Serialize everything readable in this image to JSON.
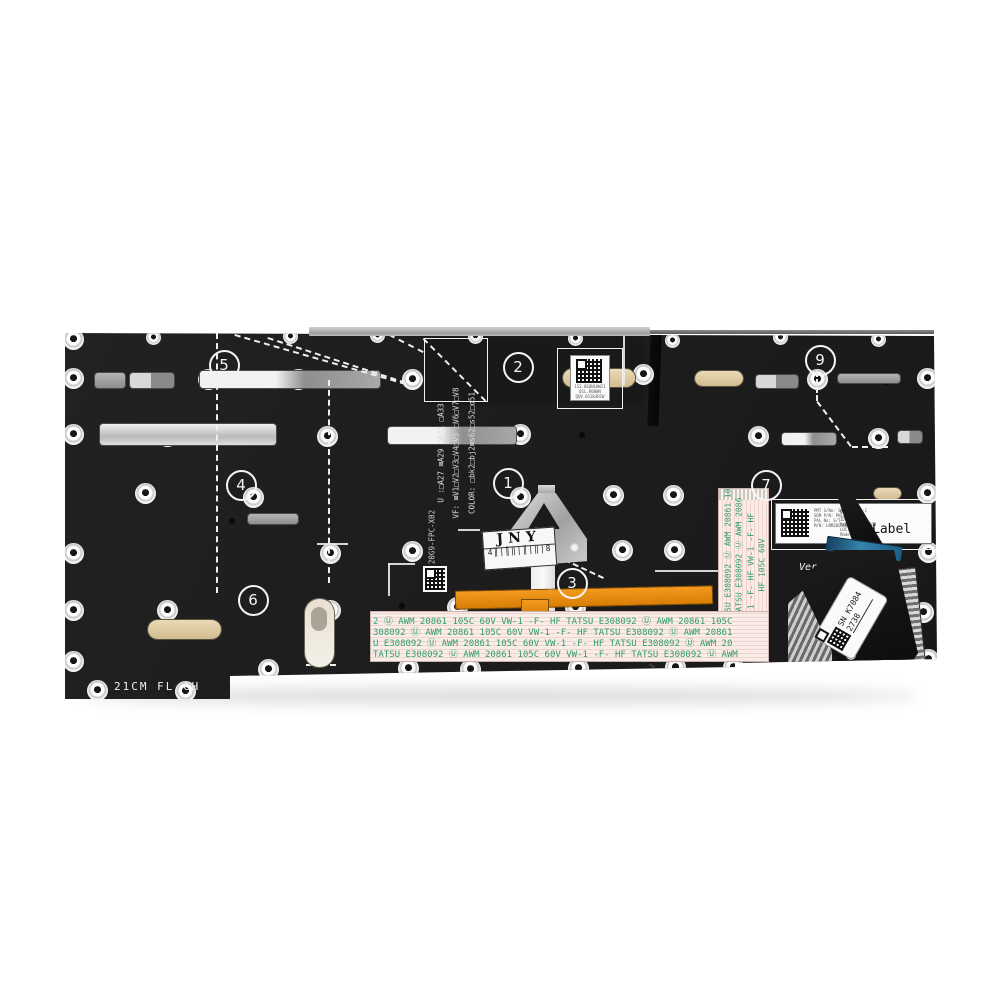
{
  "scene": {
    "description": "Product photo: rear side of a black laptop keyboard backplate with numbered callouts, ribbon cables and service labels",
    "background_color": "#ffffff"
  },
  "colors": {
    "plate": "#1d1d1d",
    "kapton_orange": "#e8890f",
    "ffc_background": "#f9ede9",
    "ffc_text_green": "#2f9e68",
    "connector_blue": "#2b6e93",
    "silver": "#c6c6c6"
  },
  "plate": {
    "bottom_marking": "21CM FL CH",
    "fpc_part_number": "20G9-FPC-X02",
    "config_lines": [
      "U :□A27 ⊠A29 □A31 □A33",
      "VF: ⊠V1□V2□V3□V4□V5 □V6□V7□V8",
      "COLOR: □bk2□bj2⊠s62□s52□o51"
    ],
    "ver_text": "Ver"
  },
  "callouts": {
    "items": [
      {
        "n": "1",
        "x": 506,
        "y": 481
      },
      {
        "n": "2",
        "x": 516,
        "y": 365
      },
      {
        "n": "3",
        "x": 570,
        "y": 581
      },
      {
        "n": "4",
        "x": 239,
        "y": 483
      },
      {
        "n": "5",
        "x": 222,
        "y": 363
      },
      {
        "n": "6",
        "x": 251,
        "y": 598
      },
      {
        "n": "7",
        "x": 764,
        "y": 483
      },
      {
        "n": "9",
        "x": 818,
        "y": 358
      }
    ]
  },
  "labels": {
    "qr_label": {
      "micro_lines": [
        "1S2.0SONLHW21",
        "01L.R080N",
        "QQV.0S1B3RCW"
      ]
    },
    "jny": {
      "title": "JNY",
      "barcode": "4║|║‖|║|‖|8"
    },
    "info": {
      "big_text": "Label",
      "cert_prefix": "c",
      "cert_mark": "UL",
      "cert_suffix": "us",
      "micro_left": [
        "PMT S/No: SN21A22080-C",
        "SDM P/N: PN131UP2B11",
        "PAL No: S/T",
        "M/N: LNM20G9KBD-USLX02"
      ],
      "micro_right": [
        "ID: L19IM3D",
        "M/N: 21YB. 85GB",
        "LOC: UHS. KBN",
        "Made in China"
      ]
    },
    "sn": {
      "line1": "SN K7084",
      "line2": "2738"
    }
  },
  "ffc": {
    "rows": [
      "2 Ⓤ AWM 20861 105C 60V VW-1 -F- HF        TATSU E308092 Ⓤ AWM 20861 105C",
      "308092 Ⓤ AWM 20861 105C 60V VW-1 -F- HF       TATSU E308092 Ⓤ AWM 20861",
      "U E308092 Ⓤ AWM 20861 105C 60V VW-1 -F- HF       TATSU E308092 Ⓤ AWM 20",
      "TATSU E308092 Ⓤ AWM 20861 105C 60V VW-1 -F- HF      TATSU E308092 Ⓤ AWM"
    ],
    "vertical_columns": [
      "TATSU E308092 Ⓤ AWM 20861 105",
      "TATSU E308092 Ⓤ AWM 2086",
      "1 -F- HF    VW-1 -F- HF",
      "HF    105C 60V"
    ]
  },
  "decor": {
    "rivets_large": [
      [
        73,
        339
      ],
      [
        73,
        378
      ],
      [
        73,
        434
      ],
      [
        73,
        553
      ],
      [
        73,
        610
      ],
      [
        73,
        661
      ],
      [
        208,
        379
      ],
      [
        298,
        379
      ],
      [
        412,
        379
      ],
      [
        643,
        374
      ],
      [
        817,
        379
      ],
      [
        927,
        378
      ],
      [
        167,
        436
      ],
      [
        327,
        436
      ],
      [
        520,
        434
      ],
      [
        758,
        436
      ],
      [
        878,
        438
      ],
      [
        145,
        493
      ],
      [
        253,
        497
      ],
      [
        520,
        497
      ],
      [
        613,
        495
      ],
      [
        673,
        495
      ],
      [
        927,
        493
      ],
      [
        330,
        553
      ],
      [
        412,
        551
      ],
      [
        622,
        550
      ],
      [
        674,
        550
      ],
      [
        928,
        552
      ],
      [
        167,
        610
      ],
      [
        330,
        610
      ],
      [
        457,
        607
      ],
      [
        575,
        607
      ],
      [
        923,
        612
      ],
      [
        97,
        690
      ],
      [
        185,
        691
      ],
      [
        268,
        669
      ],
      [
        408,
        668
      ],
      [
        470,
        669
      ],
      [
        578,
        668
      ],
      [
        675,
        667
      ],
      [
        733,
        667
      ],
      [
        928,
        659
      ]
    ],
    "rivets_small": [
      [
        153,
        337
      ],
      [
        290,
        336
      ],
      [
        377,
        335
      ],
      [
        475,
        336
      ],
      [
        575,
        338
      ],
      [
        672,
        340
      ],
      [
        780,
        337
      ],
      [
        878,
        339
      ]
    ],
    "dots": [
      [
        355,
        381
      ],
      [
        887,
        382
      ],
      [
        232,
        521
      ],
      [
        402,
        606
      ],
      [
        582,
        435
      ]
    ],
    "slots": [
      [
        95,
        373,
        30,
        15,
        "dim"
      ],
      [
        130,
        373,
        44,
        15,
        "two"
      ],
      [
        200,
        371,
        180,
        17,
        "bleft"
      ],
      [
        100,
        424,
        176,
        21,
        "bright"
      ],
      [
        388,
        427,
        128,
        17,
        "bleft"
      ],
      [
        248,
        514,
        50,
        10,
        "dim"
      ],
      [
        756,
        375,
        42,
        13,
        "two"
      ],
      [
        838,
        374,
        62,
        9,
        "dim"
      ],
      [
        782,
        433,
        54,
        12,
        "bleft"
      ],
      [
        898,
        431,
        24,
        12,
        "two"
      ]
    ],
    "pills": [
      [
        563,
        369,
        72,
        18
      ],
      [
        695,
        371,
        48,
        15
      ],
      [
        874,
        488,
        27,
        11
      ],
      [
        148,
        620,
        73,
        19
      ]
    ],
    "dashes": [
      [
        218,
        333,
        260,
        90,
        "light"
      ],
      [
        330,
        380,
        203,
        90,
        "light"
      ],
      [
        235,
        334,
        178,
        16,
        "light"
      ],
      [
        268,
        337,
        145,
        18,
        "light"
      ],
      [
        424,
        338,
        88,
        45,
        "light"
      ],
      [
        380,
        329,
        49,
        27,
        "light"
      ],
      [
        818,
        371,
        30,
        90,
        "light"
      ],
      [
        818,
        401,
        56,
        53,
        "light"
      ],
      [
        852,
        446,
        36,
        0,
        "light"
      ],
      [
        565,
        559,
        43,
        25,
        "light"
      ],
      [
        585,
        629,
        90,
        28,
        "dark"
      ],
      [
        306,
        664,
        30,
        0,
        "light"
      ]
    ],
    "outlines": [
      [
        424,
        338,
        62,
        62
      ],
      [
        557,
        348,
        64,
        59
      ],
      [
        771,
        499,
        165,
        49
      ]
    ],
    "seams": [
      [
        655,
        570,
        108,
        2
      ],
      [
        317,
        543,
        31,
        2
      ],
      [
        458,
        529,
        22,
        2
      ],
      [
        388,
        563,
        27,
        2
      ],
      [
        388,
        563,
        2,
        33
      ],
      [
        623,
        331,
        2,
        54
      ]
    ]
  }
}
